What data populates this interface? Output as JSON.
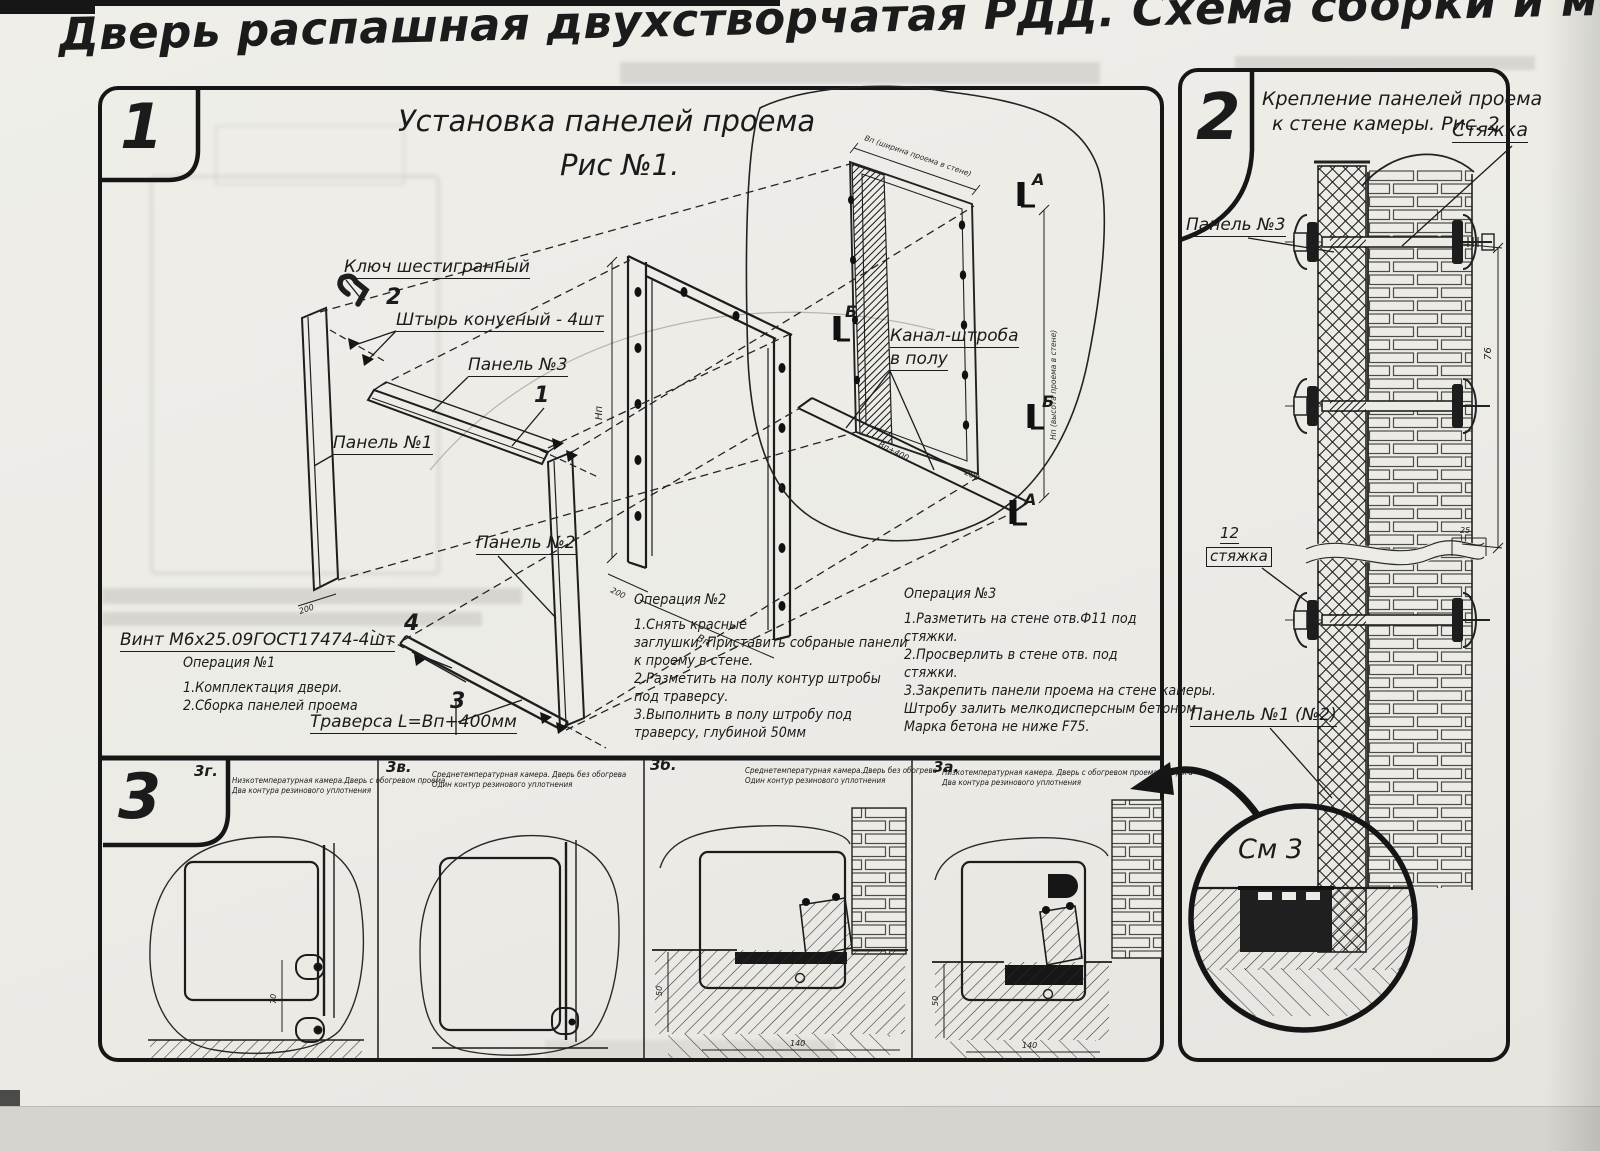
{
  "title": "Дверь распашная двухстворчатая РДД.  Схема сборки и монтажа №2",
  "panel1": {
    "number": "1",
    "caption1": "Установка панелей проема",
    "caption2": "Рис №1.",
    "labels": {
      "hex_key": "Ключ шестигранный",
      "pos2": "2",
      "pin": "Штырь конусный - 4шт",
      "panel3": "Панель №3",
      "pos1": "1",
      "panel1": "Панель №1",
      "panel2": "Панель №2",
      "pos4": "4",
      "screw": "Винт М6х25.09ГОСТ17474-4шт",
      "pos3": "3",
      "traverse": "Траверса  L=Bп+400мм",
      "channel1": "Канал-штроба",
      "channel2": "в полу",
      "marker_a": "А",
      "marker_b": "Б"
    },
    "op1": {
      "title": "Операция №1",
      "l1": "1.Комплектация двери.",
      "l2": "2.Сборка панелей проема"
    },
    "op2": {
      "title": "Операция №2",
      "l1": "1.Снять красные",
      "l2": "заглушки. Приставить собраные панели",
      "l3": "к проему в стене.",
      "l4": "2.Разметить на полу контур штробы",
      "l5": "под траверсу.",
      "l6": "3.Выполнить в полу штробу под",
      "l7": "траверсу, глубиной 50мм"
    },
    "op3": {
      "title": "Операция №3",
      "l1": "1.Разметить на стене отв.Ф11 под",
      "l2": "стяжки.",
      "l3": "2.Просверлить в стене отв.   под",
      "l4": "стяжки.",
      "l5": "3.Закрепить панели проема на стене камеры.",
      "l6": "Штробу залить мелкодисперсным бетоном",
      "l7": "Марка бетона не ниже   F75."
    },
    "dims": {
      "hn": "Нп",
      "bp": "Вп",
      "bp400": "Вп+400",
      "d200": "200",
      "note_top": "Вп (ширина проема в стене)",
      "note_side": "Нп (высота проема в стене)"
    }
  },
  "panel2": {
    "number": "2",
    "caption1": "Крепление панелей проема",
    "caption2": "к стене камеры. Рис. 2",
    "labels": {
      "tie": "Стяжка",
      "panel3": "Панель №3",
      "pos12": "12",
      "tie2": "стяжка",
      "panel12": "Панель №1 (№2)",
      "see3": "См 3"
    },
    "dims": {
      "d76": "76",
      "d25": "25"
    }
  },
  "panel3": {
    "number": "3",
    "sections": [
      {
        "id": "3г.",
        "line1": "Низкотемпературная камера.Дверь с обогревом проема",
        "line2": "Два контура резинового уплотнения"
      },
      {
        "id": "3в.",
        "line1": "Среднетемпературная камера. Дверь без обогрева",
        "line2": "Один контур резинового уплотнения"
      },
      {
        "id": "3б.",
        "line1": "Среднетемпературная камера.Дверь без обогрева",
        "line2": "Один контур резинового уплотнения"
      },
      {
        "id": "3а.",
        "line1": "Низкотемпературная камера. Дверь с обогревом проема и порога",
        "line2": "Два контура резинового уплотнения"
      }
    ],
    "dims": {
      "d70": "70",
      "d50": "50",
      "d140": "140"
    }
  }
}
